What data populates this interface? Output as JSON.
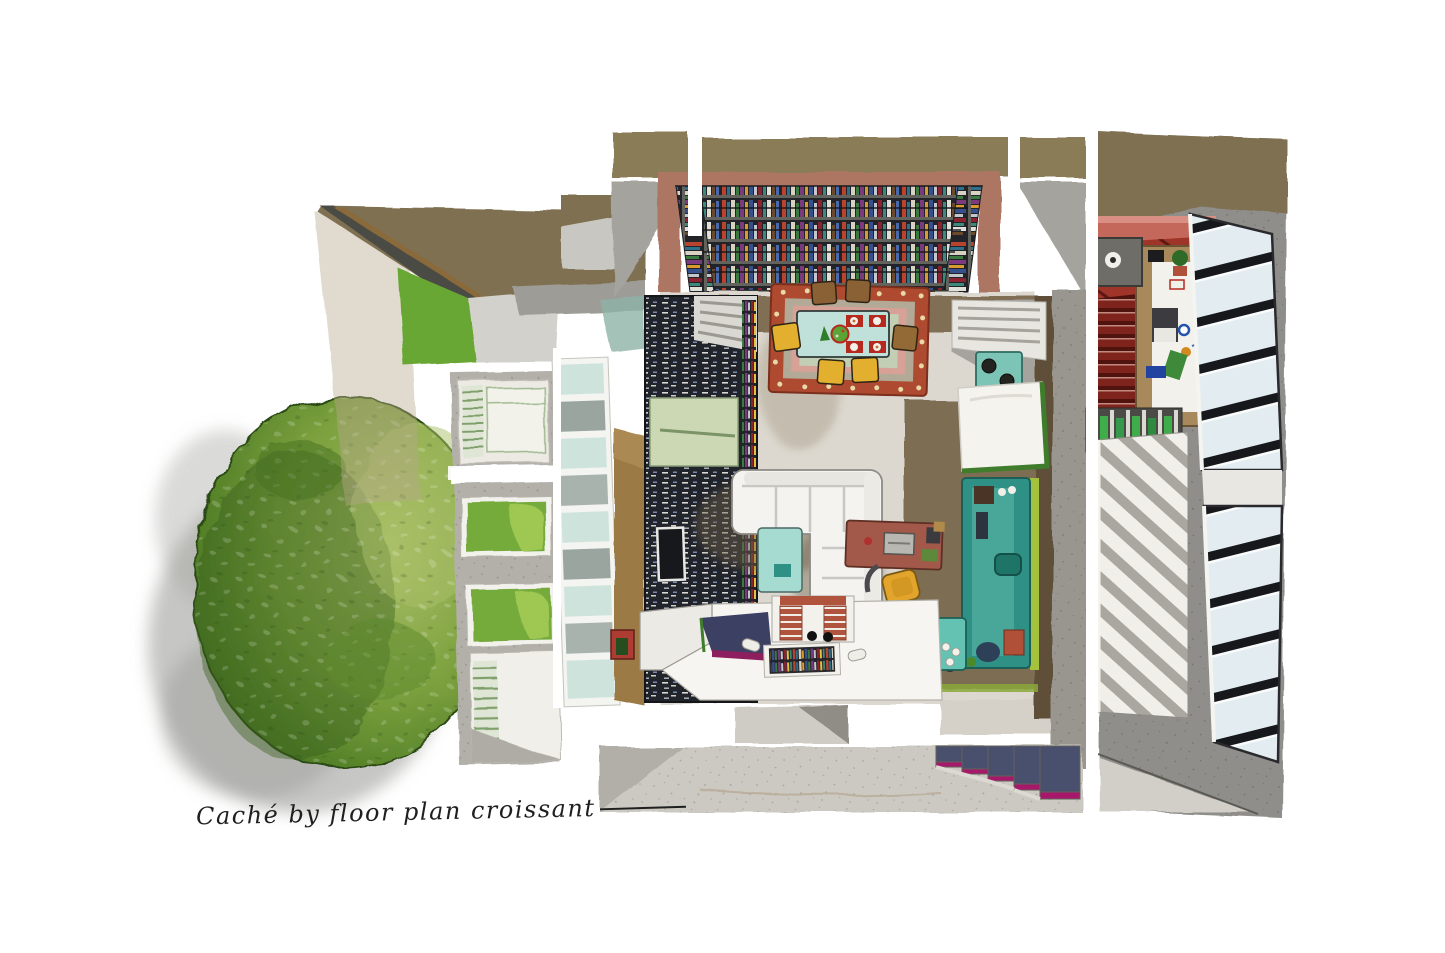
{
  "artwork": {
    "signature": "Caché by floor plan croissant",
    "signature_color": "#1f1f1f",
    "background": "#ffffff",
    "style": "watercolor top-down floor plan"
  },
  "palette": {
    "tree_mid": "#6f9c3b",
    "tree_dark": "#365e1c",
    "tree_light": "#aabf68",
    "shadow_gray": "#8e8d89",
    "concrete": "#8f8e8a",
    "concrete_light": "#ccc9c2",
    "panel_gray": "#b3b0aa",
    "roof_olive": "#7f7051",
    "roof_ridge": "#4b4b44",
    "grass": "#69a735",
    "grass_window": "#74ab3a",
    "glazing_teal": "#cfe3dd",
    "glazing_gray": "#9aa5a0",
    "wood_ochre": "#9b7a44",
    "library_band_olive": "#8a7c57",
    "wall_terracotta": "#ad7662",
    "shelf_dark": "#23242a",
    "floor_light": "#dcd8cf",
    "floor_brown": "#77654a",
    "rug_red": "#ad4a30",
    "rug_band": "#b2aa96",
    "rug_pink": "#d7a197",
    "rug_sage": "#c2cfb5",
    "table_teal": "#c0e0da",
    "placemat_red": "#b5291e",
    "chair_yellow": "#e2af2f",
    "chair_brown": "#8a6134",
    "sofa_white": "#f4f3ef",
    "coffee_table_teal": "#a5dbd1",
    "desk_brick": "#a3594a",
    "office_chair_yellow": "#e3a42c",
    "counter_teal": "#2f9185",
    "counter_edge_green": "#a4c23e",
    "bench_teal": "#63c2b2",
    "panel_sage": "#ccd8b4",
    "tv_black": "#17181c",
    "mailbox_red": "#ad3c32",
    "deck_red": "#9e3528",
    "stair_red": "#7e241c",
    "pink_wall": "#c4685c",
    "skylight_pane": "#e3edf1",
    "mullion_black": "#17181c",
    "step_navy": "#49506e",
    "step_magenta": "#a8186a",
    "void_navy": "#3c4062",
    "void_magenta": "#8e1f5e",
    "red_tread": "#b0543e"
  },
  "scene": {
    "tree": "garden tree canopy",
    "tree_shadow": "watercolor shadow wash",
    "west_facade": "west facade with grass light-wells",
    "glazed_corridor": "glazed corridor roof strip",
    "northwest_roof": "northwest roof planes with lawn patch",
    "library": "U-shaped library bookshelf seen in perspective",
    "west_wall_shelf": "dark book-spine wall with sage panel and TV",
    "dining": "dining table on oriental rug with six chairs",
    "living": "white sectional sofa and teal coffee table",
    "workspace": "brick-red desk with laptop and yellow chair",
    "kitchen": "teal kitchen counter with cooktop and sink",
    "book_bench": "teal bench with books and white knobs",
    "mezzanine": "mezzanine edge with red stair, glass floor over books, navy void",
    "right_wing": "stairwell wing with long black-mullion skylight",
    "kitchenette": "wing kitchenette with speaker, laptop and bottles",
    "bottom_strip": "lower wall strip with navy-and-magenta staircase",
    "signature_label": "artist signature"
  }
}
